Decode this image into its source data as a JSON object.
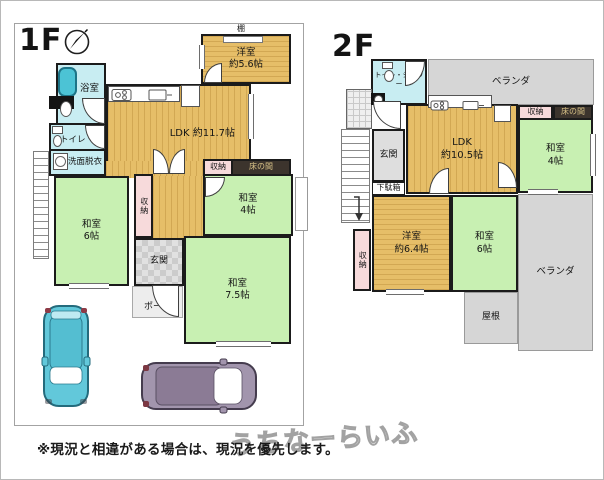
{
  "f1": {
    "label": "1F",
    "shelf": "棚",
    "youshitsu": "洋室\n約5.6帖",
    "ldk": "LDK 約11.7帖",
    "bath": "浴室",
    "toilet": "トイレ",
    "washroom": "洗面脱衣",
    "washitsu6": "和室\n6帖",
    "closet_hall": "収納",
    "closet_east": "収納",
    "tokonoma": "床の間",
    "washitsu4": "和室\n4帖",
    "washitsu75": "和室\n7.5帖",
    "genkan": "玄関",
    "porch": "ポーチ"
  },
  "f2": {
    "label": "2F",
    "toilet_shower": "トイレ・シャワー",
    "veranda_north": "ベランダ",
    "ldk": "LDK\n約10.5帖",
    "closet_north": "収納",
    "tokonoma": "床の間",
    "washitsu4": "和室\n4帖",
    "genkan": "玄関",
    "getabako": "下駄箱",
    "closet_west": "収納",
    "youshitsu": "洋室\n約6.4帖",
    "washitsu6": "和室\n6帖",
    "veranda_east": "ベランダ",
    "roof": "屋根"
  },
  "footer": {
    "disclaimer": "※現況と相違がある場合は、現況を優先します。",
    "watermark": "うちなーらいふ"
  },
  "colors": {
    "tatami_green": "#c8f0b2",
    "wood_tan": "#e6be68",
    "wet_area_cyan": "#c8edf2",
    "closet_pink": "#f7dadb",
    "veranda_gray": "#d6d6d6",
    "tokonoma_dark": "#3c342d",
    "car_teal": "#62c8da",
    "car_purple": "#a295ad"
  }
}
